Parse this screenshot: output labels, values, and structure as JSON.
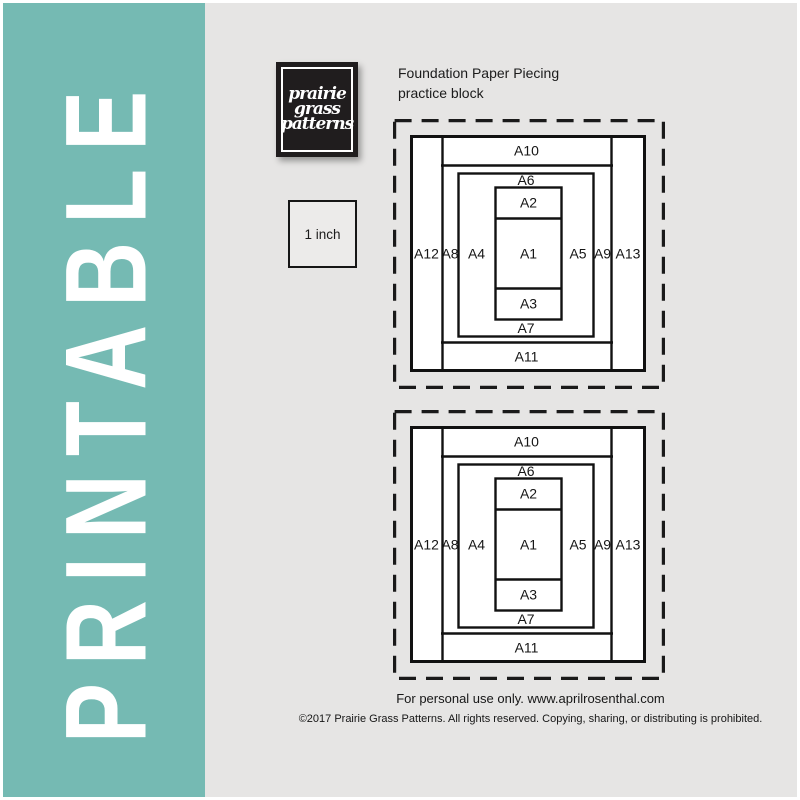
{
  "page": {
    "title_vertical": "PRINTABLE"
  },
  "logo": {
    "lines": [
      "prairie",
      "grass",
      "patterns"
    ]
  },
  "header": {
    "line1": "Foundation Paper Piecing",
    "line2": "practice block"
  },
  "scale_box": {
    "label": "1 inch"
  },
  "blocks": [
    {
      "name": "practice-block-1",
      "labels": {
        "a1": "A1",
        "a2": "A2",
        "a3": "A3",
        "a4": "A4",
        "a5": "A5",
        "a6": "A6",
        "a7": "A7",
        "a8": "A8",
        "a9": "A9",
        "a10": "A10",
        "a11": "A11",
        "a12": "A12",
        "a13": "A13"
      }
    },
    {
      "name": "practice-block-2",
      "labels": {
        "a1": "A1",
        "a2": "A2",
        "a3": "A3",
        "a4": "A4",
        "a5": "A5",
        "a6": "A6",
        "a7": "A7",
        "a8": "A8",
        "a9": "A9",
        "a10": "A10",
        "a11": "A11",
        "a12": "A12",
        "a13": "A13"
      }
    }
  ],
  "footer": {
    "line1": "For personal use only. www.aprilrosenthal.com",
    "line2": "©2017 Prairie Grass Patterns. All rights reserved. Copying, sharing, or distributing is prohibited."
  },
  "colors": {
    "teal": "#75bab3",
    "background": "#e6e5e4",
    "line": "#1a1a1a"
  }
}
